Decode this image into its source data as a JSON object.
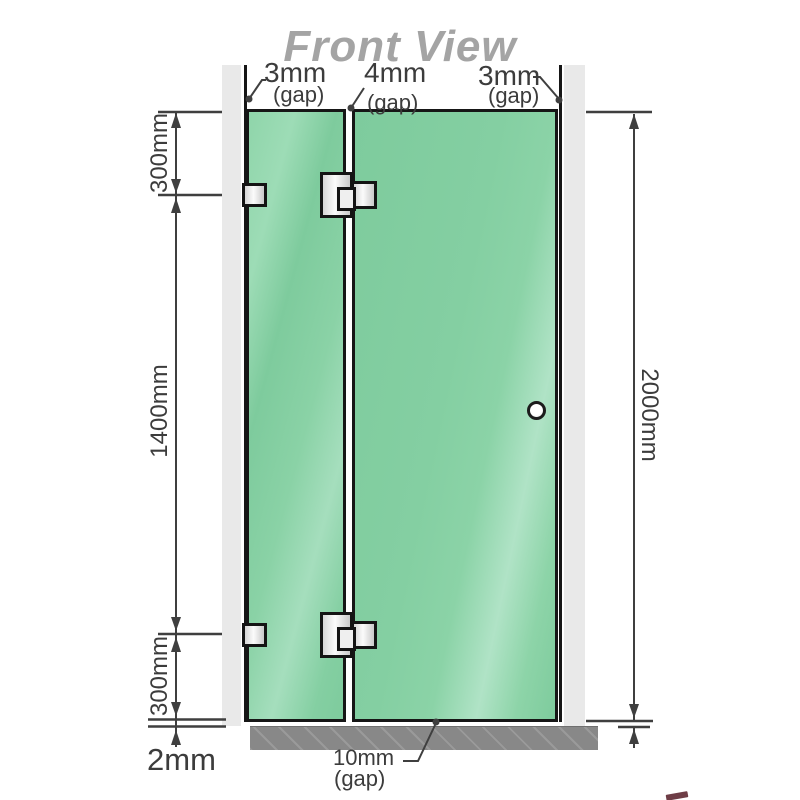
{
  "title": "Front View",
  "labels": {
    "gap_top_left": {
      "value": "3mm",
      "gap": "(gap)"
    },
    "gap_top_mid": {
      "value": "4mm",
      "gap": "(gap)"
    },
    "gap_top_right": {
      "value": "3mm",
      "gap": "(gap)"
    },
    "height_top": "300mm",
    "height_mid": "1400mm",
    "height_bottom": "300mm",
    "floor_clearance": "2mm",
    "total_height": "2000mm",
    "gap_bottom": {
      "value": "10mm",
      "gap": "(gap)"
    }
  },
  "colors": {
    "glass_green": "#84cfa2",
    "glass_sheen": "#b0e3c6",
    "wall_gray": "#e9e9e9",
    "base_gray": "#8f8f8f",
    "outline_black": "#161616",
    "dimension_line": "#3f3f3f",
    "title_gray": "#a4a4a4"
  }
}
